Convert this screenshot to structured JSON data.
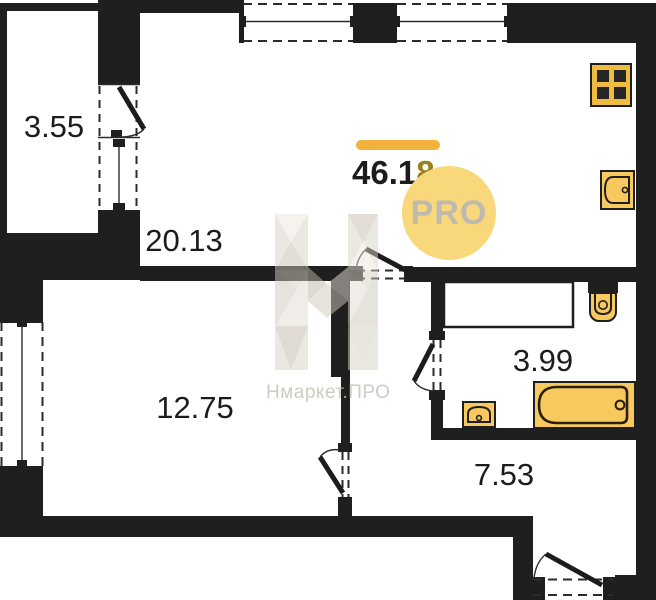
{
  "plan_title": "apartment-floor-plan",
  "rooms": {
    "balcony": {
      "name": "balcony",
      "area": "3.55"
    },
    "living": {
      "name": "living-kitchen",
      "area": "20.13"
    },
    "bedroom": {
      "name": "bedroom",
      "area": "12.75"
    },
    "bathroom": {
      "name": "bathroom",
      "area": "3.99"
    },
    "hallway": {
      "name": "hallway",
      "area": "7.53"
    }
  },
  "total": {
    "area": "46.18",
    "main": "46.1",
    "accent": "8"
  },
  "badge": {
    "label": "PRO"
  },
  "watermark": {
    "text": "Нмаркет.ПРО"
  },
  "fixtures": [
    "stove",
    "kitchen-sink",
    "toilet",
    "ventilation-shaft",
    "bathroom-sink",
    "bathtub"
  ],
  "colors": {
    "wall": "#1f1f1f",
    "fixture_fill": "#F7C95F",
    "stove_fill": "#EFBC3F",
    "accent_bar": "#F3B23E",
    "accent_digit": "#9A7F1E",
    "badge_bg": "#F8D87A",
    "badge_text": "#BFBAB0",
    "watermark": "#C8C2B6"
  }
}
